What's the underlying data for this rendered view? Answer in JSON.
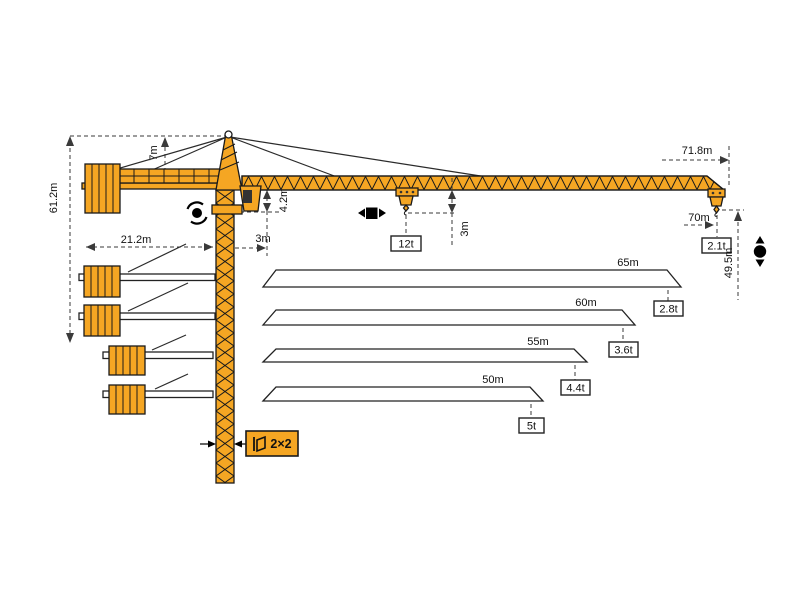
{
  "labels": {
    "total_height": "61.2m",
    "tower_head_height": "7m",
    "counter_jib_radius": "21.2m",
    "min_radius": "3m",
    "jib_section_depth": "4.2m",
    "hook_clearance": "3m",
    "max_jib_length": "71.8m",
    "max_hook_radius": "70m",
    "tip_capacity": "2.1t",
    "height_under_hook": "49.5m",
    "max_capacity": "12t",
    "mast_section": "2×2"
  },
  "configurations": [
    {
      "jib_length": "65m",
      "tip_capacity": "2.8t"
    },
    {
      "jib_length": "60m",
      "tip_capacity": "3.6t"
    },
    {
      "jib_length": "55m",
      "tip_capacity": "4.4t"
    },
    {
      "jib_length": "50m",
      "tip_capacity": "5t"
    }
  ],
  "icons": {
    "slewing": "rotation-arrows-around-dot",
    "trolley_travel": "left-right-arrows-square",
    "hoisting": "up-down-arrows-dot",
    "mast_section": "skewed-square-flag"
  },
  "colors": {
    "crane_orange": "#F5A623",
    "outline": "#1A1A1A",
    "dimension_line": "#3A3A3A",
    "symbol_black": "#000000",
    "label_box_bg": "#FFFFFF"
  }
}
